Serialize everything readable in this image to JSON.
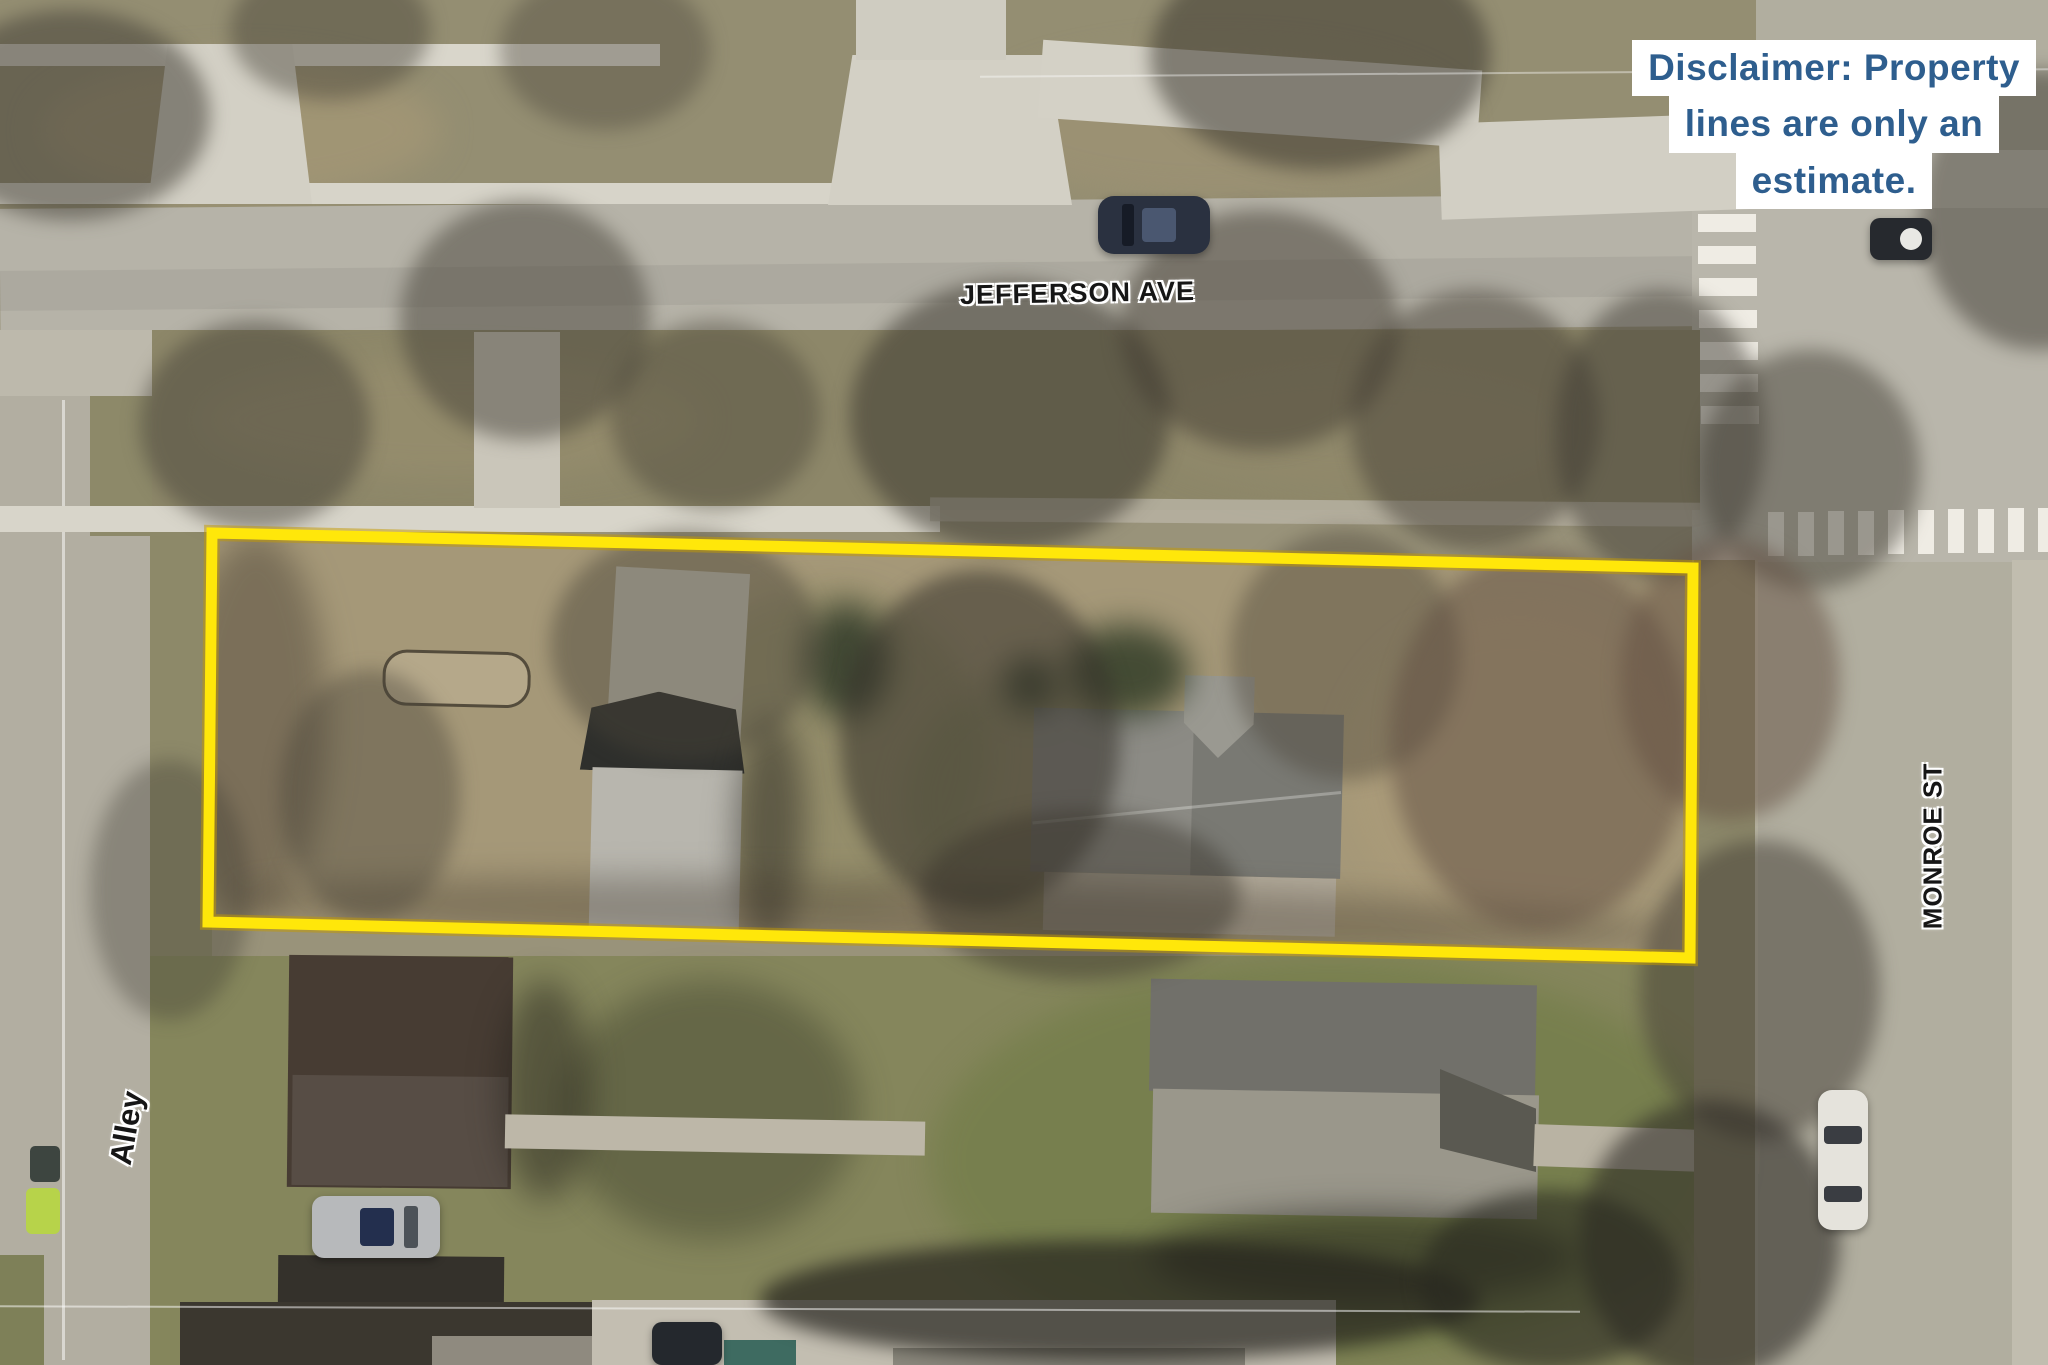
{
  "title": "Aerial parcel map with estimated property lines",
  "labels": {
    "jefferson": "JEFFERSON AVE",
    "monroe": "MONROE ST",
    "alley": "Alley"
  },
  "overlay": {
    "disclaimer": {
      "line1": "Disclaimer: Property",
      "line2": "lines are only an",
      "line3": "estimate.",
      "text_color": "#2e5e8e",
      "background": "#ffffff"
    },
    "property_boundary": {
      "color": "#ffe70a",
      "glow_color": "rgba(196,154,0,0.5)",
      "stroke_width": "11",
      "glow_width": "16",
      "points": "212,533 1693,568 1690,958 208,922"
    }
  }
}
